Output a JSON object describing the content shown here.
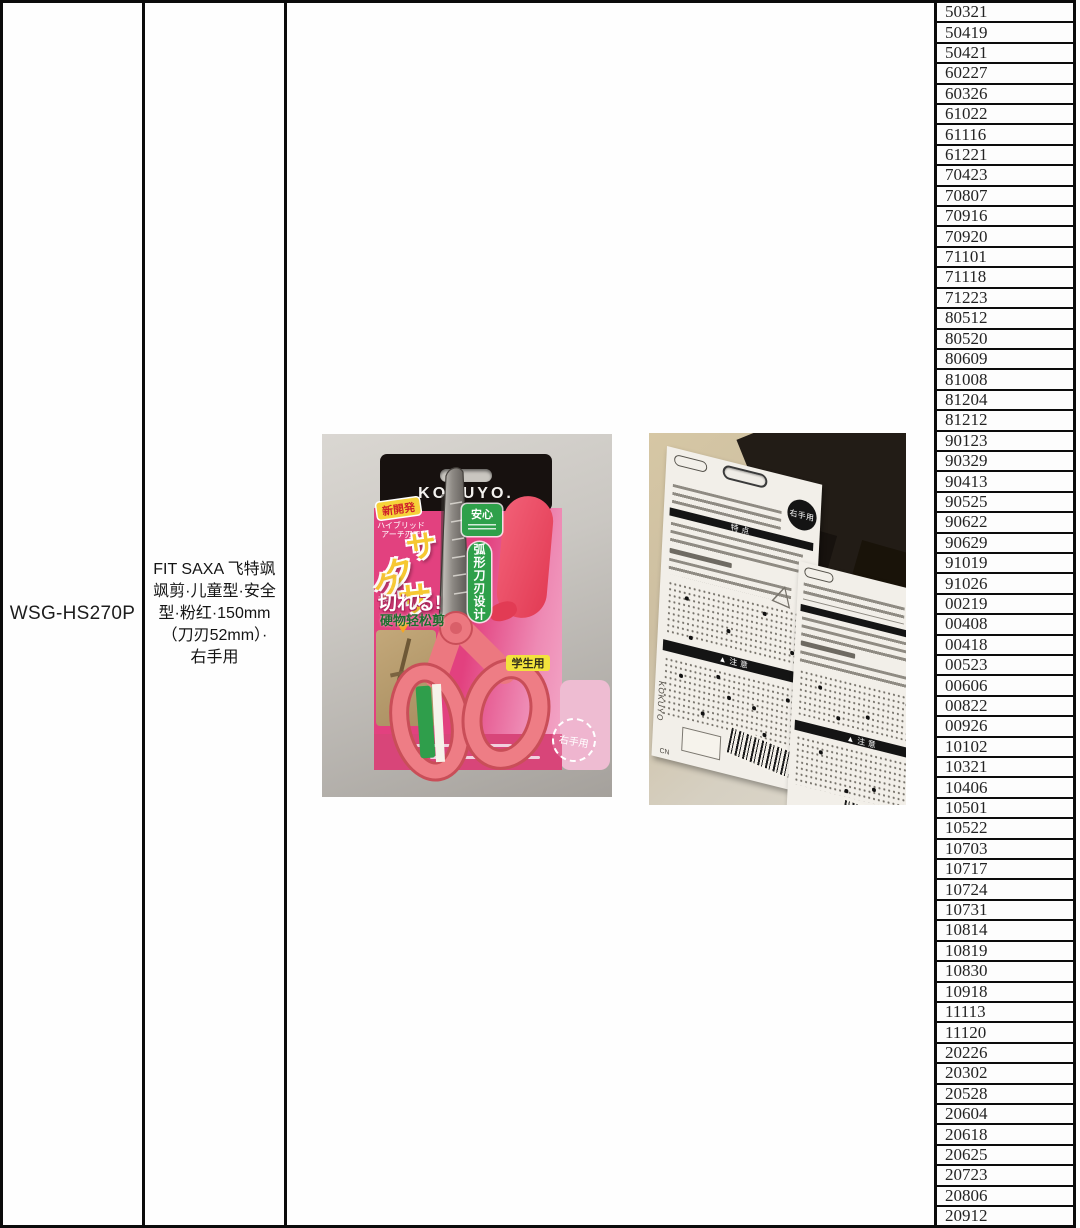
{
  "document": {
    "model": "WSG-HS270P",
    "description_lines": [
      "FIT SAXA 飞特飒",
      "飒剪·儿童型·安全",
      "型·粉红·150mm",
      "（刀刃52mm）·",
      "右手用"
    ],
    "serials": [
      "50321",
      "50419",
      "50421",
      "60227",
      "60326",
      "61022",
      "61116",
      "61221",
      "70423",
      "70807",
      "70916",
      "70920",
      "71101",
      "71118",
      "71223",
      "80512",
      "80520",
      "80609",
      "81008",
      "81204",
      "81212",
      "90123",
      "90329",
      "90413",
      "90525",
      "90622",
      "90629",
      "91019",
      "91026",
      "00219",
      "00408",
      "00418",
      "00523",
      "00606",
      "00822",
      "00926",
      "10102",
      "10321",
      "10406",
      "10501",
      "10522",
      "10703",
      "10717",
      "10724",
      "10731",
      "10814",
      "10819",
      "10830",
      "10918",
      "11113",
      "11120",
      "20226",
      "20302",
      "20528",
      "20604",
      "20618",
      "20625",
      "20723",
      "20806",
      "20912"
    ]
  },
  "photo_front": {
    "brand": "KOKUYO.",
    "new_badge": "新開発",
    "sub_copy_1": "ハイブリッド",
    "sub_copy_2": "アーチ刃で",
    "big_chars": [
      "サ",
      "ク",
      "サ",
      "ク"
    ],
    "cut_copy": "切れる!",
    "hard_copy": "硬物轻松剪",
    "safe_badge": "安心",
    "arc_label": "弧形刀刃设计",
    "student_badge": "学生用",
    "hand_note": "右手用"
  },
  "photo_back": {
    "hand_badge": "右手用",
    "features_bar": "特点",
    "caution_bar": "▲注意",
    "brand_small": "KOKUYO",
    "origin_small": "CN"
  },
  "palette": {
    "card_pink": "#e2417f",
    "handle_coral": "#ee7d85",
    "cover_red": "#e23b54",
    "accent_green": "#2ea04a",
    "accent_yellow": "#f6d23a",
    "bar_black": "#141414"
  }
}
